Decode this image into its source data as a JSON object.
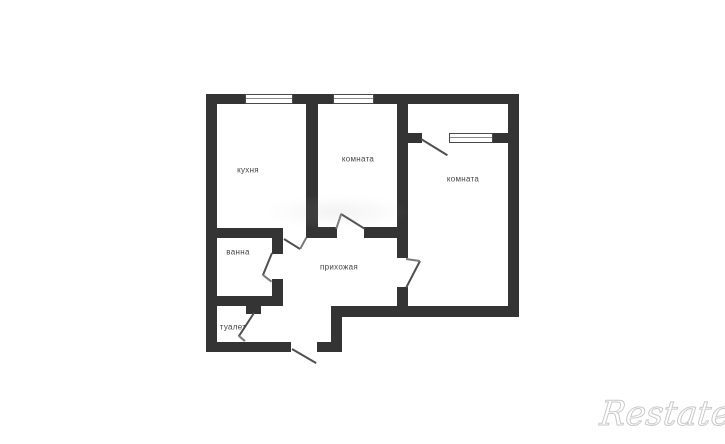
{
  "plan": {
    "rooms": [
      {
        "id": "kitchen",
        "label": "кухня"
      },
      {
        "id": "room-center",
        "label": "комната"
      },
      {
        "id": "room-right",
        "label": "комната"
      },
      {
        "id": "bathroom",
        "label": "ванна"
      },
      {
        "id": "toilet",
        "label": "туалет"
      },
      {
        "id": "hallway",
        "label": "прихожая"
      }
    ]
  },
  "watermark": {
    "brand": "Restate"
  },
  "colors": {
    "wall": "#343434",
    "door_line": "#4f4f4f",
    "label_text": "#454545",
    "watermark_stroke": "#c9c9c9",
    "background": "#ffffff"
  }
}
